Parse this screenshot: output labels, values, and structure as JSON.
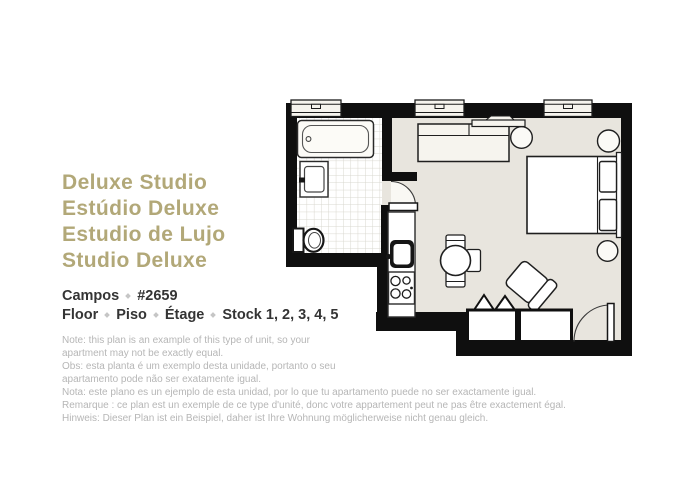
{
  "header": {
    "titles": [
      "Deluxe Studio",
      "Estúdio Deluxe",
      "Estudio de Lujo",
      "Studio Deluxe"
    ],
    "building": "Campos",
    "unit_number": "#2659",
    "floor_words": [
      "Floor",
      "Piso",
      "Étage"
    ],
    "floors_stock": "Stock 1, 2, 3, 4, 5"
  },
  "notes": [
    "Note: this plan is an example of this type of unit, so your",
    "apartment may not be exactly equal.",
    "Obs: esta planta é um exemplo desta unidade, portanto o seu",
    "apartamento pode não ser exatamente igual.",
    "Nota: este plano es un ejemplo de esta unidad, por lo que tu apartamento puede no ser exactamente igual.",
    "Remarque : ce plan est un exemple de ce type d'unité, donc votre appartement peut ne pas être exactement égal.",
    "Hinweis: Dieser Plan ist ein Beispiel, daher ist Ihre Wohnung möglicherweise nicht genau gleich."
  ],
  "colors": {
    "title_gold": "#b2a878",
    "text_dark": "#343434",
    "note_gray": "#b6b6b6",
    "wall_black": "#0f0f0f",
    "floor_beige": "#e8e5de",
    "fixture_cream": "#f6f4ee",
    "tile_line": "#d9d7cf"
  }
}
